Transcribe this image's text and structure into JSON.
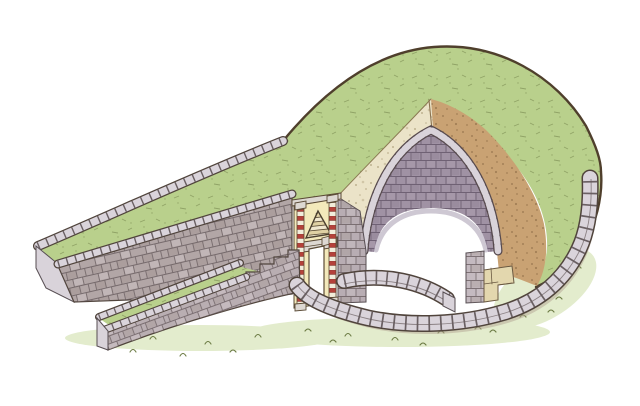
{
  "illustration": {
    "subject": "cutaway-tholos-tomb-with-dromos-and-burial-mound"
  },
  "palette": {
    "bg": "#ffffff",
    "grass": "#b9d08c",
    "grassDark": "#6e7d46",
    "grassWash": "#e3eccd",
    "outline": "#4f3f2c",
    "cream": "#ebe3c8",
    "creamSpeck": "#9b8a64",
    "tan": "#c9a273",
    "tanSpeck": "#7d5c39",
    "mauve": "#a092a4",
    "mauveDark": "#5e5064",
    "stoneFace": "#b2a6a6",
    "stoneMid": "#b8adb3",
    "stoneLight": "#d9d3da",
    "stoneDark": "#564d52",
    "capLight": "#dad4db",
    "bandOutline": "#50443c",
    "joint": "#564b4d",
    "jointSoft": "#6a5e60",
    "facadeCream": "#f3e9bb",
    "columnRed": "#b5413a",
    "columnWhite": "#f2eddb",
    "lintel": "#ddd8d2",
    "stripeLight": "#f0e8cf",
    "stripeDark": "#dfd1a4",
    "outlineWarm": "#5a4a35",
    "shadow": "#b3a394"
  }
}
